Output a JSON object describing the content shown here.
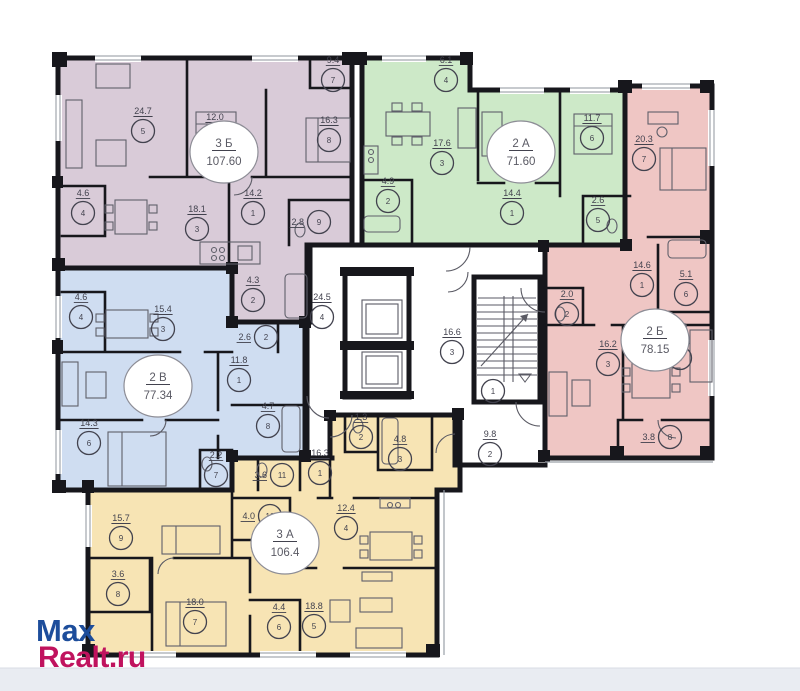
{
  "watermark": {
    "line1": "Max",
    "line2": "Realt.ru",
    "color1": "#1d4d9b",
    "color2": "#c0135e"
  },
  "apartments": [
    {
      "id": "3b",
      "type": "3 Б",
      "area": "107.60",
      "color": "#d9cbd8",
      "label": {
        "x": 224,
        "y": 152
      },
      "rooms": [
        {
          "n": "5",
          "a": "24.7",
          "x": 143,
          "y": 131
        },
        {
          "n": "6",
          "a": "12.0",
          "x": 215,
          "y": 137
        },
        {
          "n": "8",
          "a": "16.3",
          "x": 329,
          "y": 140
        },
        {
          "n": "7",
          "a": "9.4",
          "x": 333,
          "y": 80
        },
        {
          "n": "4",
          "a": "4.6",
          "x": 83,
          "y": 213
        },
        {
          "n": "3",
          "a": "18.1",
          "x": 197,
          "y": 229
        },
        {
          "n": "1",
          "a": "14.2",
          "x": 253,
          "y": 213
        },
        {
          "n": "9",
          "a": "2.8",
          "x": 319,
          "y": 222,
          "side": true
        },
        {
          "n": "2",
          "a": "4.3",
          "x": 253,
          "y": 300
        }
      ]
    },
    {
      "id": "2a",
      "type": "2 А",
      "area": "71.60",
      "color": "#cde9c8",
      "label": {
        "x": 521,
        "y": 152
      },
      "rooms": [
        {
          "n": "4",
          "a": "6.1",
          "x": 446,
          "y": 80
        },
        {
          "n": "3",
          "a": "17.6",
          "x": 442,
          "y": 163
        },
        {
          "n": "6",
          "a": "11.7",
          "x": 592,
          "y": 138
        },
        {
          "n": "2",
          "a": "4.9",
          "x": 388,
          "y": 201
        },
        {
          "n": "1",
          "a": "14.4",
          "x": 512,
          "y": 213
        },
        {
          "n": "5",
          "a": "2.6",
          "x": 598,
          "y": 220
        }
      ]
    },
    {
      "id": "2b",
      "type": "2 Б",
      "area": "78.15",
      "color": "#efc6c4",
      "label": {
        "x": 655,
        "y": 340
      },
      "rooms": [
        {
          "n": "7",
          "a": "20.3",
          "x": 644,
          "y": 159
        },
        {
          "n": "1",
          "a": "14.6",
          "x": 642,
          "y": 285
        },
        {
          "n": "6",
          "a": "5.1",
          "x": 686,
          "y": 294
        },
        {
          "n": "2",
          "a": "2.0",
          "x": 567,
          "y": 314
        },
        {
          "n": "3",
          "a": "16.2",
          "x": 608,
          "y": 364
        },
        {
          "n": "4",
          "a": "15.3",
          "x": 680,
          "y": 358
        },
        {
          "n": "8",
          "a": "3.8",
          "x": 670,
          "y": 437,
          "side": true
        }
      ]
    },
    {
      "id": "2v",
      "type": "2 В",
      "area": "77.34",
      "color": "#cfddf1",
      "label": {
        "x": 158,
        "y": 386
      },
      "rooms": [
        {
          "n": "4",
          "a": "4.6",
          "x": 81,
          "y": 317
        },
        {
          "n": "3",
          "a": "15.4",
          "x": 163,
          "y": 329
        },
        {
          "n": "2",
          "a": "2.6",
          "x": 266,
          "y": 337,
          "side": true
        },
        {
          "n": "1",
          "a": "11.8",
          "x": 239,
          "y": 380
        },
        {
          "n": "8",
          "a": "4.7",
          "x": 268,
          "y": 426
        },
        {
          "n": "6",
          "a": "14.3",
          "x": 89,
          "y": 443
        },
        {
          "n": "7",
          "a": "2.2",
          "x": 216,
          "y": 475
        }
      ]
    },
    {
      "id": "3a",
      "type": "3 А",
      "area": "106.4",
      "color": "#f7e4b4",
      "label": {
        "x": 285,
        "y": 543
      },
      "rooms": [
        {
          "n": "9",
          "a": "15.7",
          "x": 121,
          "y": 538
        },
        {
          "n": "8",
          "a": "3.6",
          "x": 118,
          "y": 594
        },
        {
          "n": "7",
          "a": "18.0",
          "x": 195,
          "y": 622
        },
        {
          "n": "10",
          "a": "4.0",
          "x": 270,
          "y": 516,
          "side": true
        },
        {
          "n": "11",
          "a": "3.6",
          "x": 282,
          "y": 475,
          "side": true
        },
        {
          "n": "1",
          "a": "16.3",
          "x": 320,
          "y": 473
        },
        {
          "n": "2",
          "a": "1.3",
          "x": 361,
          "y": 437
        },
        {
          "n": "3",
          "a": "4.8",
          "x": 400,
          "y": 459
        },
        {
          "n": "4",
          "a": "12.4",
          "x": 346,
          "y": 528
        },
        {
          "n": "6",
          "a": "4.4",
          "x": 279,
          "y": 627
        },
        {
          "n": "5",
          "a": "18.8",
          "x": 314,
          "y": 626
        }
      ]
    }
  ],
  "common": {
    "rooms": [
      {
        "n": "4",
        "a": "24.5",
        "x": 322,
        "y": 317
      },
      {
        "n": "3",
        "a": "16.6",
        "x": 452,
        "y": 352
      },
      {
        "n": "1",
        "a": "",
        "x": 493,
        "y": 391
      },
      {
        "n": "2",
        "a": "9.8",
        "x": 490,
        "y": 454
      }
    ]
  }
}
